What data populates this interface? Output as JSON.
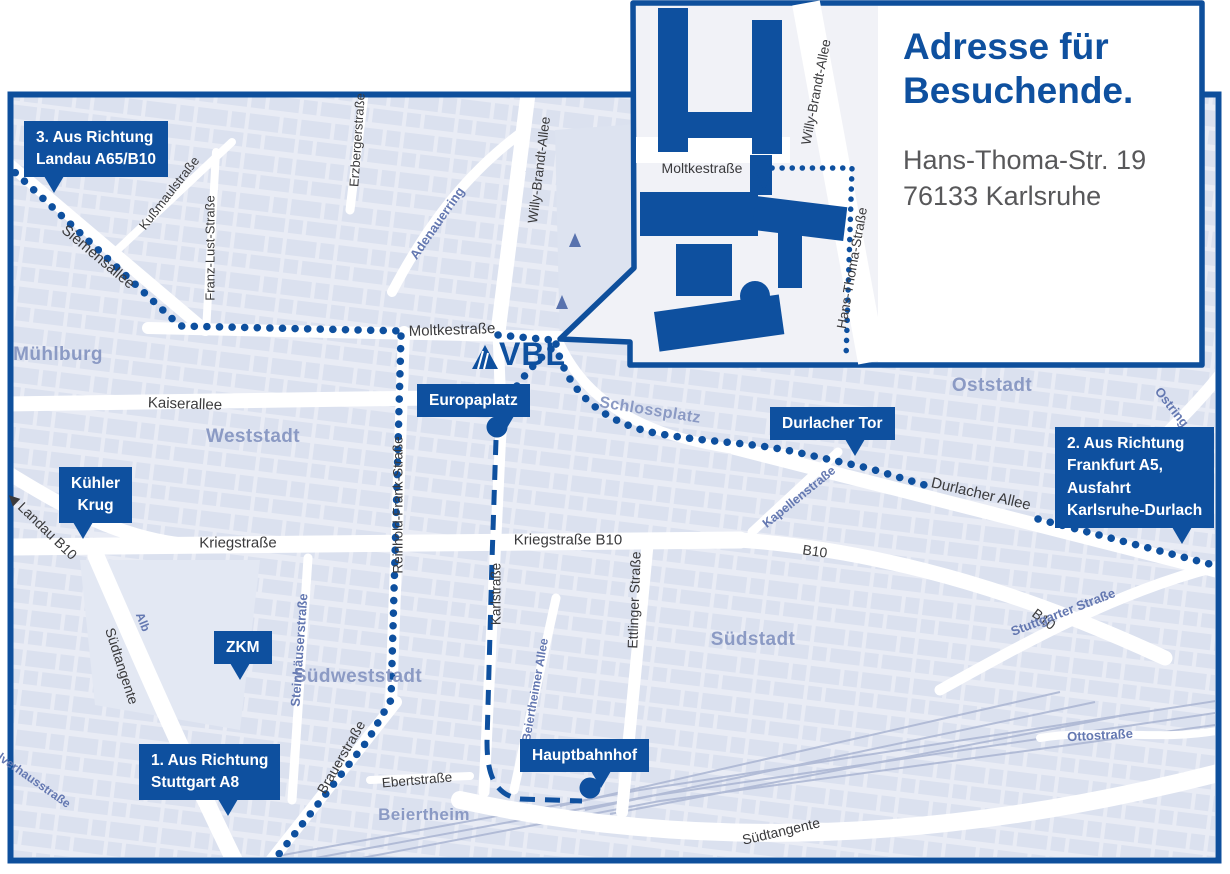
{
  "inset": {
    "title_line1": "Adresse für",
    "title_line2": "Besuchende.",
    "address_line1": "Hans-Thoma-Str. 19",
    "address_line2": "76133 Karlsruhe",
    "street_labels": [
      {
        "text": "Moltkestraße",
        "x": 702,
        "y": 168,
        "rot": 0,
        "cls": "dark",
        "size": 14
      },
      {
        "text": "Willy-Brandt-Allee",
        "x": 816,
        "y": 92,
        "rot": -79,
        "cls": "dark",
        "size": 13.5
      },
      {
        "text": "Hans-Thoma-Straße",
        "x": 852,
        "y": 268,
        "rot": -80,
        "cls": "dark",
        "size": 13.5
      }
    ]
  },
  "logo": {
    "text": "VBL",
    "mark": "triangle-icon"
  },
  "map": {
    "callouts": [
      {
        "lines": [
          "3. Aus Richtung",
          "Landau A65/B10"
        ],
        "x": 24,
        "y": 121,
        "tail_left": 20,
        "center": false
      },
      {
        "lines": [
          "Kühler",
          "Krug"
        ],
        "x": 59,
        "y": 467,
        "tail_left": 14,
        "center": true
      },
      {
        "lines": [
          "ZKM"
        ],
        "x": 214,
        "y": 631,
        "tail_left": 16,
        "center": true
      },
      {
        "lines": [
          "Europaplatz"
        ],
        "x": 417,
        "y": 384,
        "tail_right": 16,
        "center": false
      },
      {
        "lines": [
          "Durlacher Tor"
        ],
        "x": 770,
        "y": 407,
        "tail_right": 30,
        "center": false
      },
      {
        "lines": [
          "2. Aus Richtung",
          "Frankfurt A5,",
          "Ausfahrt",
          "Karlsruhe-Durlach"
        ],
        "x": 1055,
        "y": 427,
        "tail_right": 22,
        "center": false
      },
      {
        "lines": [
          "1. Aus Richtung",
          "Stuttgart A8"
        ],
        "x": 139,
        "y": 744,
        "tail_right": 42,
        "center": false
      },
      {
        "lines": [
          "Hauptbahnhof"
        ],
        "x": 520,
        "y": 739,
        "tail_right": 38,
        "center": false
      }
    ],
    "street_labels": [
      {
        "text": "Mühlburg",
        "x": 58,
        "y": 355,
        "rot": 0,
        "cls": "district",
        "size": 19
      },
      {
        "text": "Weststadt",
        "x": 253,
        "y": 437,
        "rot": 0,
        "cls": "district",
        "size": 19
      },
      {
        "text": "Oststadt",
        "x": 992,
        "y": 386,
        "rot": 0,
        "cls": "district",
        "size": 19
      },
      {
        "text": "Südstadt",
        "x": 753,
        "y": 640,
        "rot": 0,
        "cls": "district",
        "size": 19
      },
      {
        "text": "Südweststadt",
        "x": 358,
        "y": 677,
        "rot": 0,
        "cls": "district",
        "size": 19
      },
      {
        "text": "Beiertheim",
        "x": 424,
        "y": 815,
        "rot": 0,
        "cls": "district",
        "size": 17
      },
      {
        "text": "Schlossplatz",
        "x": 650,
        "y": 411,
        "rot": 9,
        "cls": "district",
        "size": 16
      },
      {
        "text": "Siemensallee",
        "x": 98,
        "y": 257,
        "rot": 40,
        "cls": "dark",
        "size": 15
      },
      {
        "text": "Kußmaulstraße",
        "x": 169,
        "y": 193,
        "rot": -52,
        "cls": "dark",
        "size": 13
      },
      {
        "text": "Franz-Lust-Straße",
        "x": 210,
        "y": 248,
        "rot": -90,
        "cls": "dark",
        "size": 13
      },
      {
        "text": "Erzbergerstraße",
        "x": 357,
        "y": 140,
        "rot": -86,
        "cls": "dark",
        "size": 13
      },
      {
        "text": "Moltkestraße",
        "x": 452,
        "y": 330,
        "rot": -2,
        "cls": "dark",
        "size": 15
      },
      {
        "text": "Kaiserallee",
        "x": 185,
        "y": 404,
        "rot": 2,
        "cls": "dark",
        "size": 15
      },
      {
        "text": "Willy-Brandt-Allee",
        "x": 539,
        "y": 170,
        "rot": -83,
        "cls": "dark",
        "size": 13.5
      },
      {
        "text": "Adenauerring",
        "x": 437,
        "y": 223,
        "rot": -55,
        "cls": "blue",
        "size": 13
      },
      {
        "text": "Reinhold-Frank-Straße",
        "x": 398,
        "y": 505,
        "rot": -90,
        "cls": "dark",
        "size": 13.5
      },
      {
        "text": "Kapellenstraße",
        "x": 799,
        "y": 497,
        "rot": -39,
        "cls": "blue",
        "size": 12.5
      },
      {
        "text": "Durlacher Allee",
        "x": 981,
        "y": 494,
        "rot": 13,
        "cls": "dark",
        "size": 15
      },
      {
        "text": "Ostring",
        "x": 1172,
        "y": 407,
        "rot": 52,
        "cls": "blue",
        "size": 13
      },
      {
        "text": "Kriegstraße",
        "x": 238,
        "y": 543,
        "rot": 0,
        "cls": "dark",
        "size": 15
      },
      {
        "text": "Kriegstraße B10",
        "x": 568,
        "y": 540,
        "rot": 0,
        "cls": "dark",
        "size": 15
      },
      {
        "text": "◀ Landau B10",
        "x": 42,
        "y": 526,
        "rot": 44,
        "cls": "dark",
        "size": 14
      },
      {
        "text": "B10",
        "x": 815,
        "y": 551,
        "rot": 8,
        "cls": "dark",
        "size": 14
      },
      {
        "text": "B10",
        "x": 1044,
        "y": 619,
        "rot": 37,
        "cls": "dark",
        "size": 14
      },
      {
        "text": "Alb",
        "x": 143,
        "y": 622,
        "rot": 68,
        "cls": "blue",
        "size": 12
      },
      {
        "text": "Südtangente",
        "x": 122,
        "y": 666,
        "rot": 72,
        "cls": "dark",
        "size": 14
      },
      {
        "text": "Steinhäuserstraße",
        "x": 299,
        "y": 650,
        "rot": -86,
        "cls": "blue",
        "size": 13
      },
      {
        "text": "Karlstraße",
        "x": 496,
        "y": 594,
        "rot": -90,
        "cls": "dark",
        "size": 13.5
      },
      {
        "text": "Ettlinger Straße",
        "x": 634,
        "y": 600,
        "rot": -88,
        "cls": "dark",
        "size": 14
      },
      {
        "text": "Beiertheimer Allee",
        "x": 535,
        "y": 690,
        "rot": -80,
        "cls": "blue",
        "size": 12
      },
      {
        "text": "Stuttgarter Straße",
        "x": 1063,
        "y": 612,
        "rot": -21,
        "cls": "blue",
        "size": 13
      },
      {
        "text": "Ebertstraße",
        "x": 417,
        "y": 780,
        "rot": -5,
        "cls": "dark",
        "size": 13.5
      },
      {
        "text": "Brauerstraße",
        "x": 341,
        "y": 757,
        "rot": -60,
        "cls": "dark",
        "size": 14
      },
      {
        "text": "Südtangente",
        "x": 781,
        "y": 831,
        "rot": -13,
        "cls": "dark",
        "size": 14
      },
      {
        "text": "Ottostraße",
        "x": 1100,
        "y": 735,
        "rot": -3,
        "cls": "blue",
        "size": 13
      },
      {
        "text": "Pulverhausstraße",
        "x": 28,
        "y": 776,
        "rot": 35,
        "cls": "blue",
        "size": 12
      }
    ]
  },
  "colors": {
    "brand_blue": "#0e509f",
    "map_background": "#e9ecf5",
    "block_fill": "#d8deed",
    "district_label": "#8b9ac4",
    "blue_street_label": "#6478b1",
    "dark_street_label": "#3a3a3c",
    "address_text": "#58585a",
    "road_white": "#ffffff"
  }
}
